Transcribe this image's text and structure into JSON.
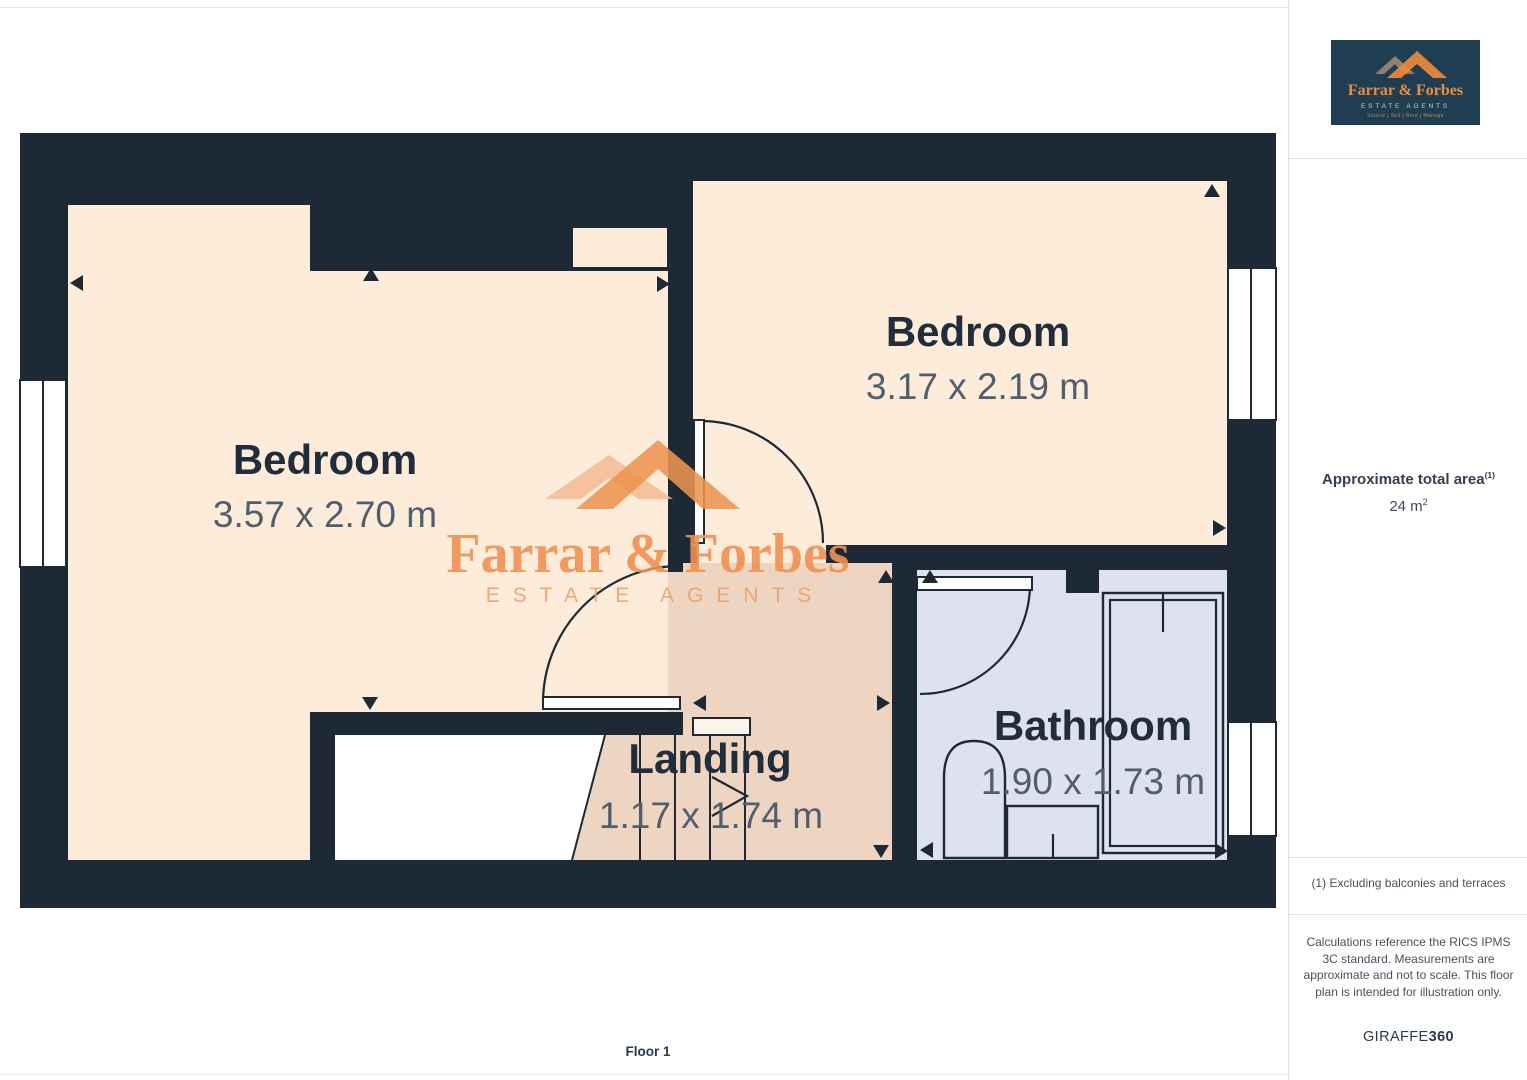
{
  "page": {
    "floor_label": "Floor 1"
  },
  "watermark": {
    "name": "Farrar & Forbes",
    "subtitle": "ESTATE AGENTS"
  },
  "logo": {
    "name": "Farrar & Forbes",
    "subtitle": "ESTATE AGENTS",
    "tagline": "Source | Sell | Rent | Manage"
  },
  "sidebar": {
    "area_title": "Approximate total area",
    "area_title_sup": "(1)",
    "area_value": "24 m",
    "area_value_sup": "2",
    "footnote": "(1) Excluding balconies and terraces",
    "disclaimer": "Calculations reference the RICS IPMS 3C standard. Measurements are approximate and not to scale. This floor plan is intended for illustration only.",
    "provider_name": "GIRAFFE",
    "provider_suffix": "360"
  },
  "floorplan": {
    "rooms": [
      {
        "name": "Bedroom",
        "dimensions": "3.57 x 2.70 m"
      },
      {
        "name": "Bedroom",
        "dimensions": "3.17 x 2.19 m"
      },
      {
        "name": "Landing",
        "dimensions": "1.17 x 1.74 m"
      },
      {
        "name": "Bathroom",
        "dimensions": "1.90 x 1.73 m"
      }
    ],
    "colors": {
      "wall": "#1d2934",
      "room": "#fdecd9",
      "landing": "#eed5c1",
      "bathroom": "#dde2ee",
      "accent_orange": "#ef9252",
      "logo_background": "#1f3e51"
    }
  }
}
